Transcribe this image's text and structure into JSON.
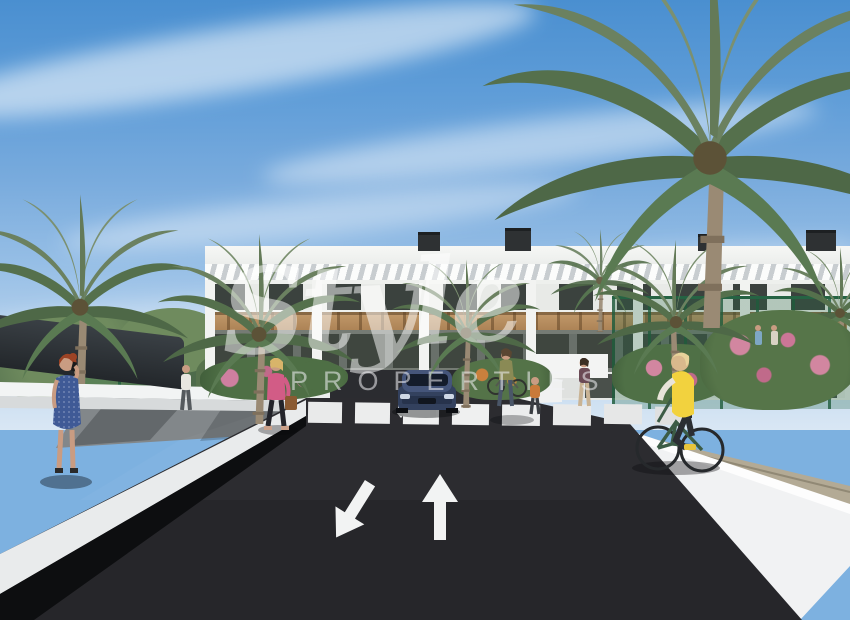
{
  "watermark": {
    "script": "Style",
    "caption": "PROPERTIES"
  },
  "markings": {
    "oncoming_arrow_icon": "lane-arrow-down-left",
    "straight_arrow_icon": "lane-arrow-up",
    "crosswalk_stripe_count": 8
  },
  "palette": {
    "sky_top": "#4a8fd0",
    "sky_horizon": "#d9e7f4",
    "asphalt": "#26262a",
    "wall_white": "#f2f4f4",
    "wood_band": "#b98e5e",
    "palm_green": "#5f7a55",
    "fence_green": "#2f6b4a",
    "flower_pink": "#d286a0",
    "car_navy": "#33415e",
    "vest_yellow": "#f2d23e",
    "dress_blue": "#3f5a96",
    "top_pink": "#d25c86"
  }
}
